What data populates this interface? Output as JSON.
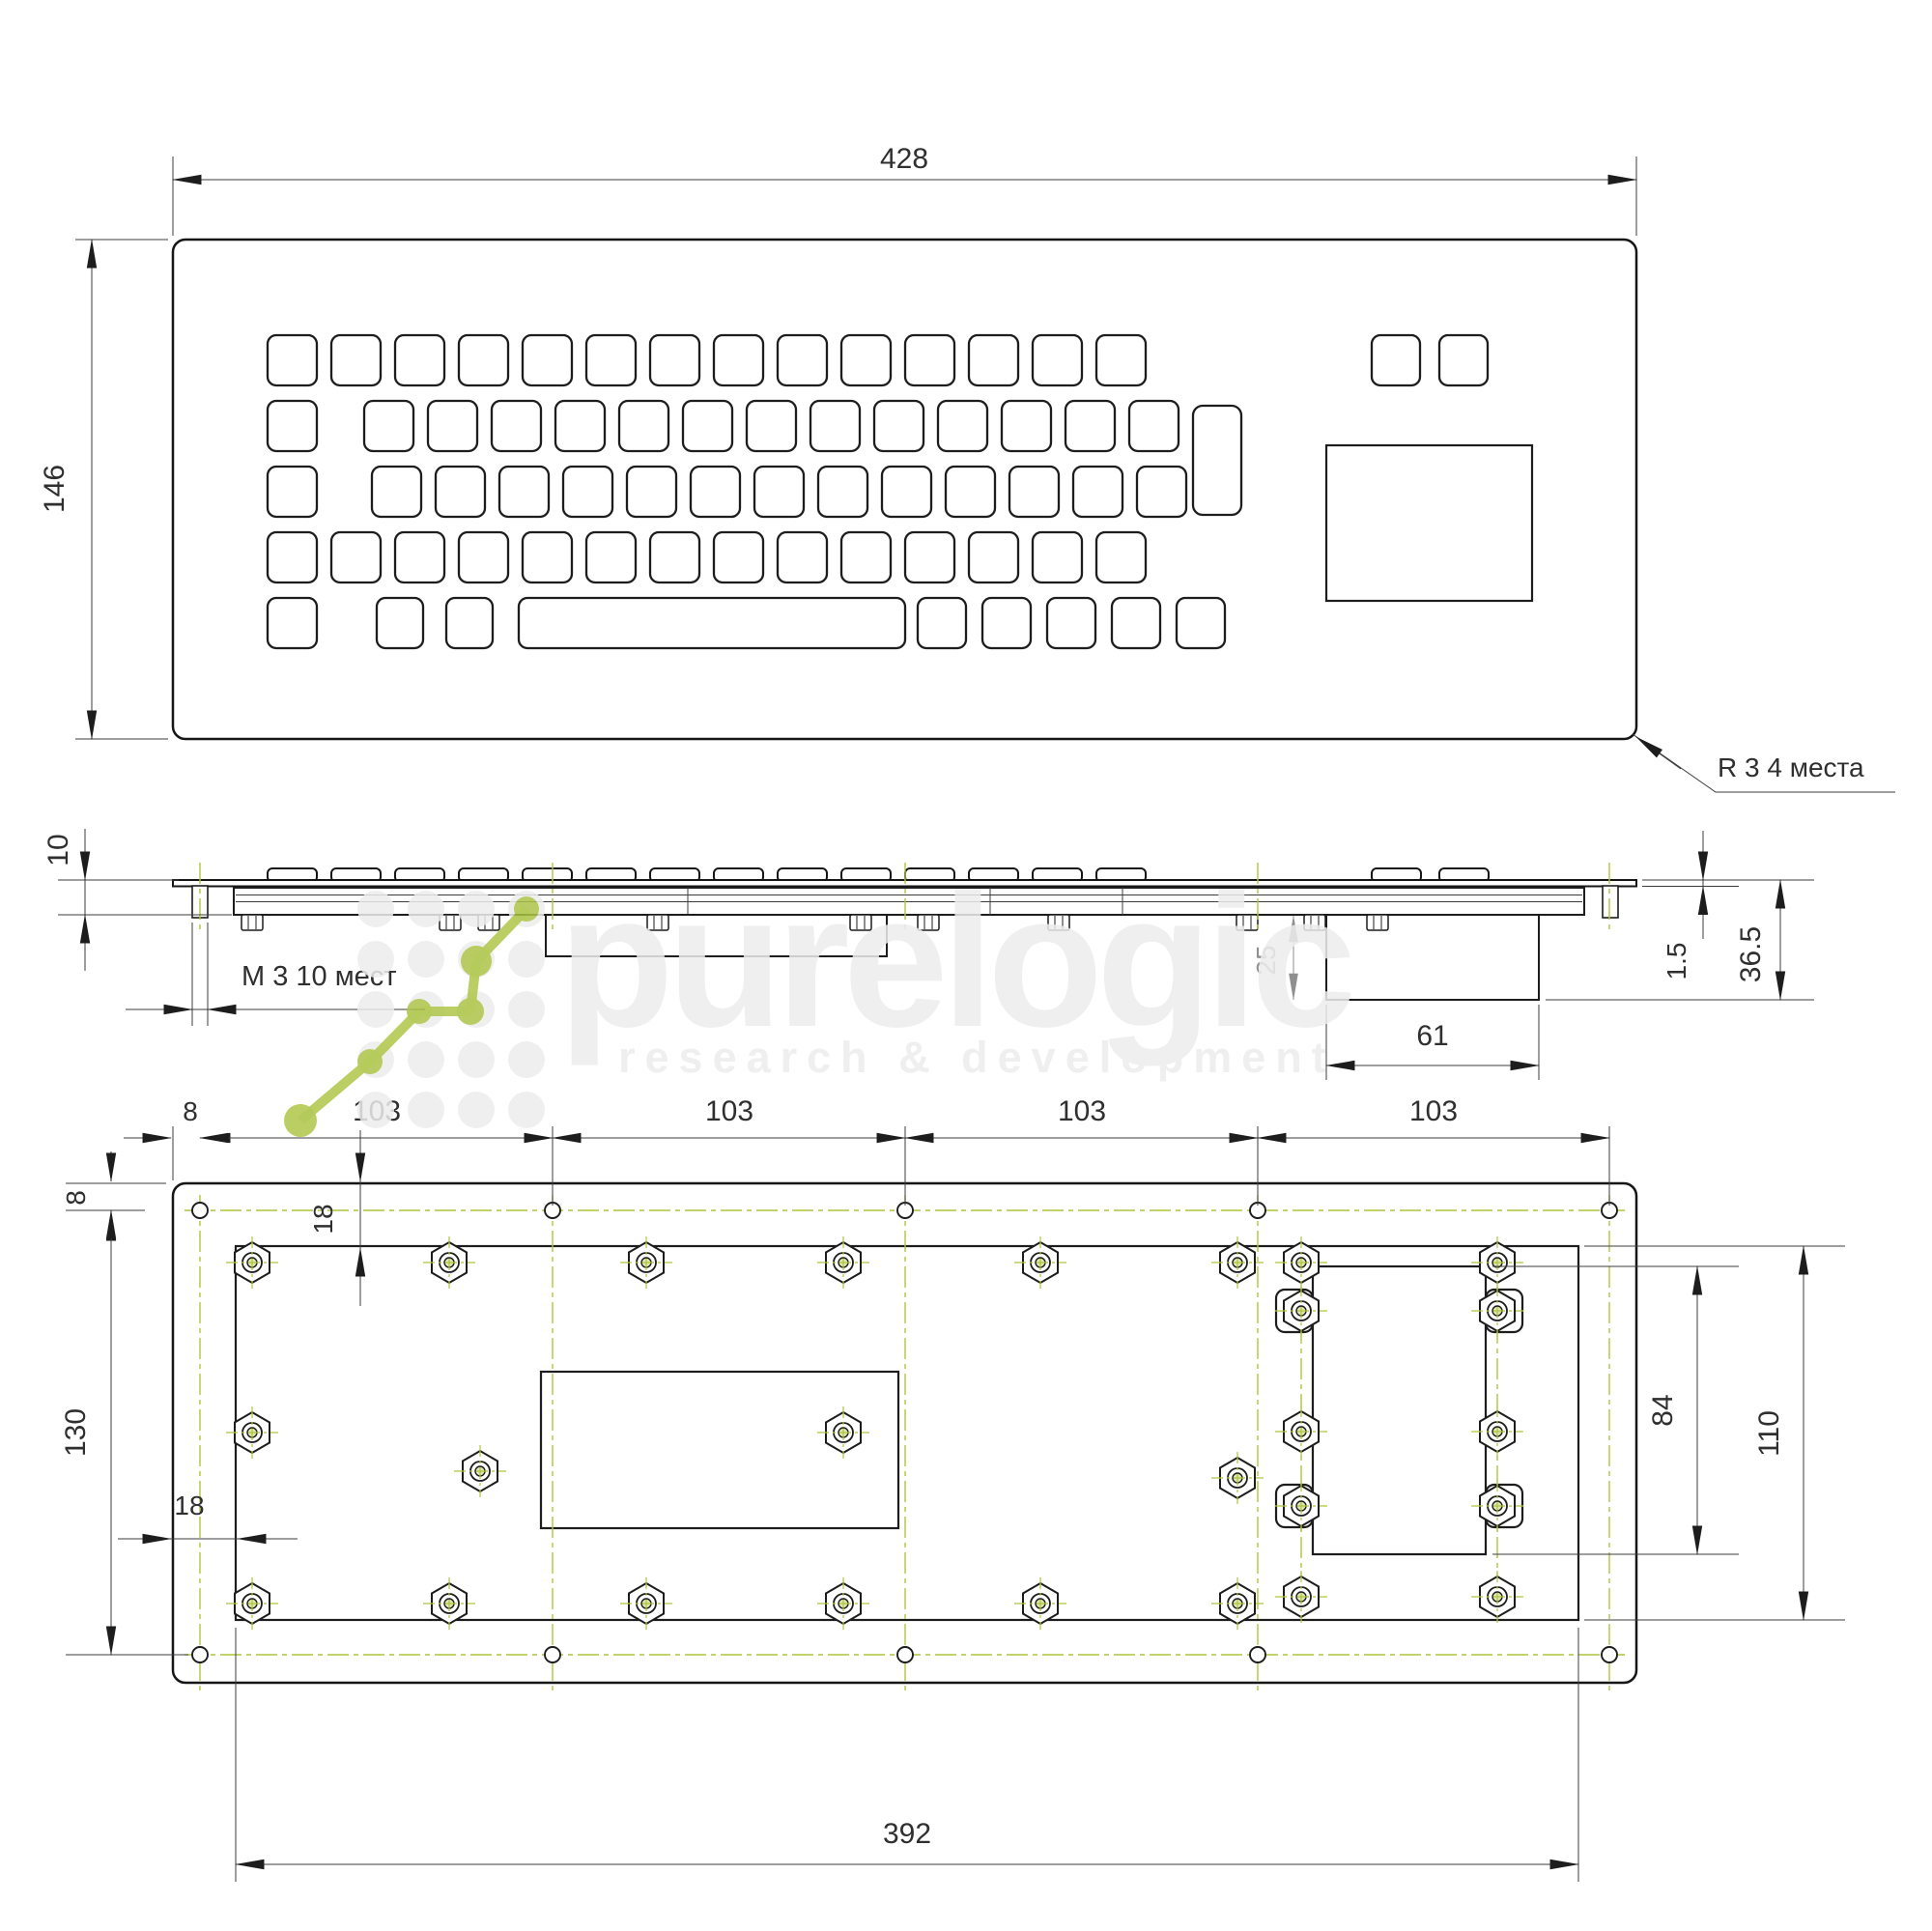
{
  "watermark": {
    "brand": "purelogic",
    "tagline": "research & development"
  },
  "front_view": {
    "width": "428",
    "height": "146",
    "corner_note": "R 3  4 места"
  },
  "side_view": {
    "height": "10",
    "screw_note": "М 3  10 мест",
    "sheet_thickness": "1.5",
    "total_depth": "36.5",
    "module_depth": "25",
    "module_width": "61"
  },
  "back_view": {
    "edge_offset_top": "8",
    "edge_offset_left": "8",
    "hole_pitch": [
      "103",
      "103",
      "103",
      "103"
    ],
    "inset_top": "18",
    "inset_left": "18",
    "hole_span": "130",
    "cutout_height": "84",
    "module_height": "110",
    "plate_width": "392"
  }
}
